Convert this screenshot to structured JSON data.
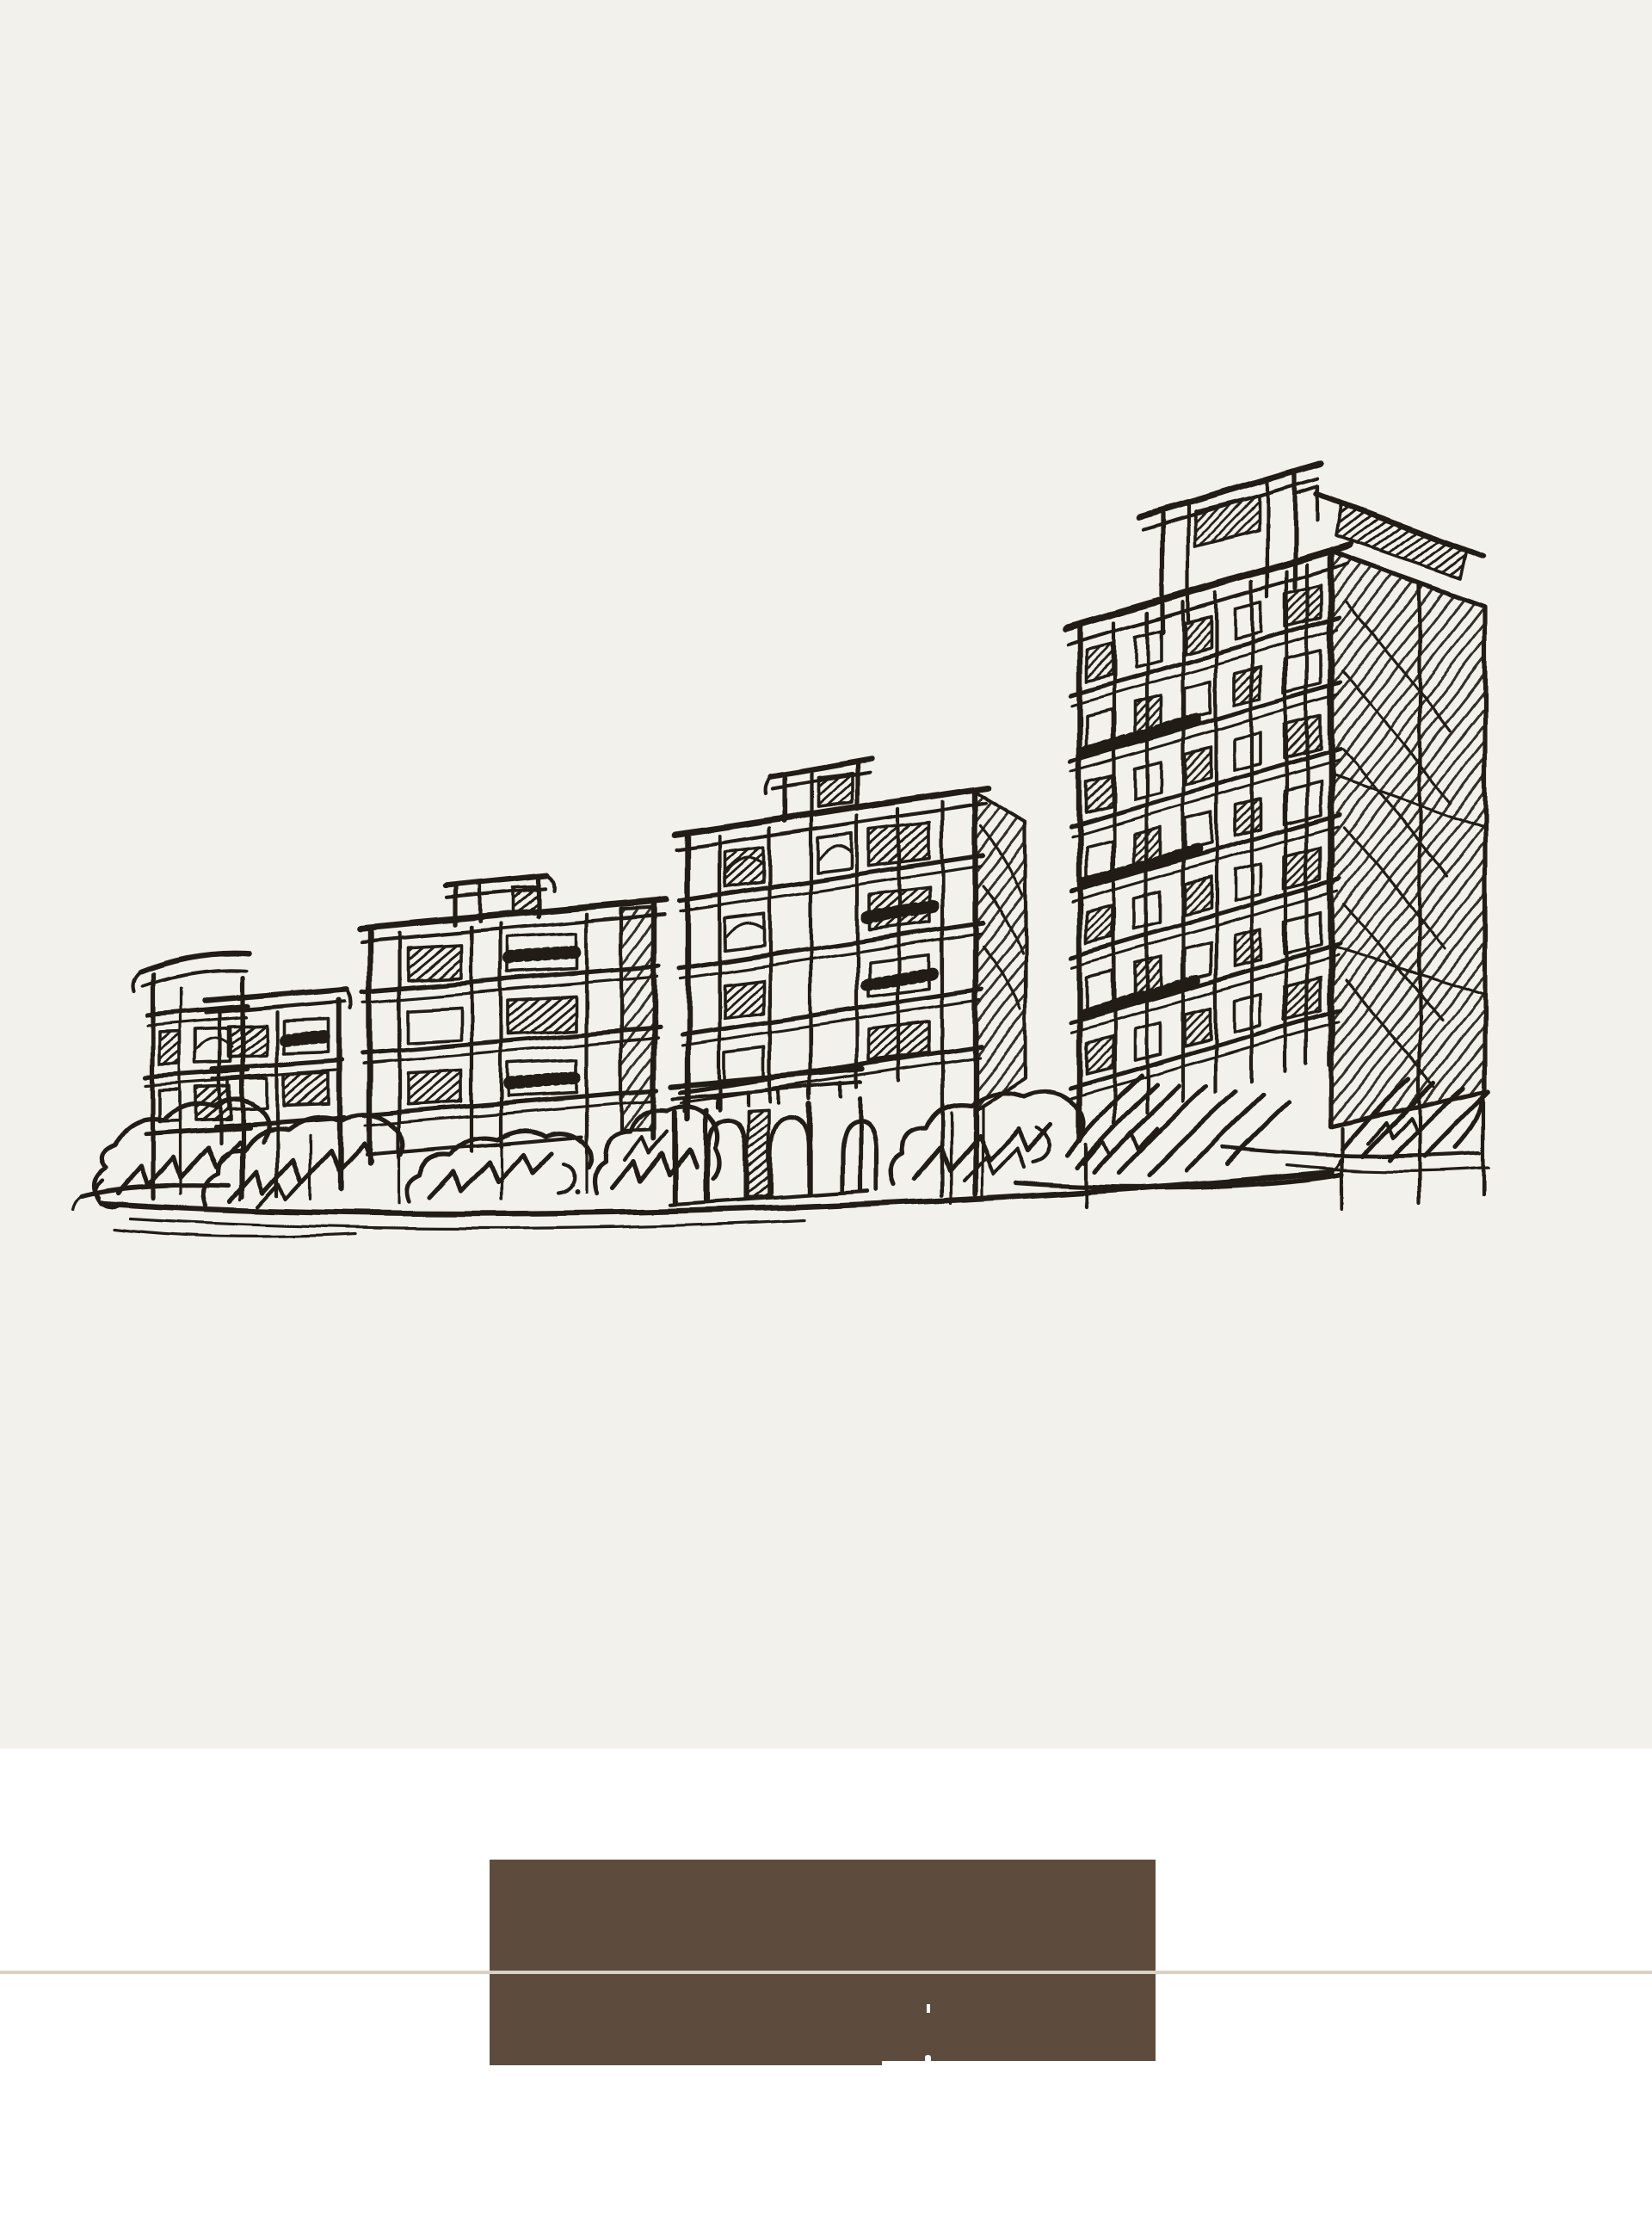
{
  "meta": {
    "page_type": "minimal brochure page: architectural sketch hero over white footer band with brown panel"
  },
  "colors": {
    "page_background": "#ffffff",
    "paper": "#f2f1ec",
    "ink": "#221e19",
    "footer_panel": "#5d4c3e",
    "divider": "#d9d0c3",
    "fragment_white": "#ffffff"
  },
  "hero": {
    "illustration_alt": "Hand-drawn black ink sketch of four mid-rise residential buildings increasing in height from left to right, with hatched windows, scribbled shrubs at their bases, an arched entrance portico and a sweeping ground line on cream paper"
  },
  "footer": {
    "panel_alt": "Solid dark brown rectangular panel with two tiny white fragments and a thin light notch at its lower edge",
    "divider_alt": "Thin full-width tan horizontal rule crossing the page and the brown panel"
  }
}
